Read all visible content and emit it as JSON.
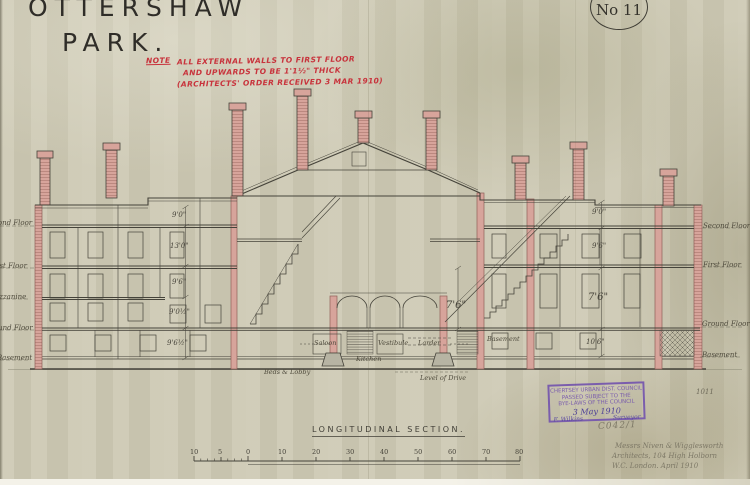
{
  "title": {
    "line1": "OTTERSHAW",
    "line2": "PARK."
  },
  "drawing_number": "No 11",
  "note": {
    "label": "NOTE",
    "line1": "ALL EXTERNAL WALLS TO FIRST FLOOR",
    "line2": "AND UPWARDS TO BE 1'1½\" THICK",
    "line3": "(ARCHITECTS' ORDER RECEIVED 3 MAR 1910)"
  },
  "section_title": "LONGITUDINAL SECTION.",
  "floor_labels": {
    "right": [
      "Second Floor",
      "First Floor",
      "Ground Floor",
      "Basement"
    ],
    "left": [
      "Second Floor",
      "First Floor",
      "Mezzanine",
      "Ground Floor",
      "Basement"
    ]
  },
  "dimensions": {
    "left": [
      "9'0\"",
      "13'0\"",
      "9'6\"",
      "9'0½\"",
      "9'6½\""
    ],
    "right": [
      "9'0\"",
      "9'6\"",
      "7'6\"",
      "10'6\""
    ],
    "center": "7'6\""
  },
  "rooms": {
    "saloon": "Saloon",
    "kitchen": "Kitchen",
    "vestibule": "Vestibule",
    "larder": "Larder",
    "basement": "Basement",
    "beds_lobby": "Beds & Lobby",
    "level_of_drive": "Level of Drive"
  },
  "scale_bar": {
    "labels": [
      "10",
      "5",
      "0",
      "10",
      "20",
      "30",
      "40",
      "50",
      "60",
      "70",
      "80"
    ]
  },
  "stamp": {
    "line1": "CHERTSEY URBAN DIST. COUNCIL",
    "line2": "PASSED SUBJECT TO THE",
    "line3": "BYE-LAWS OF THE COUNCIL",
    "date": "3 May 1910",
    "signature": "F. Wilkins",
    "officer_title": "Surveyor"
  },
  "annotations": {
    "ref_number": "C042/1",
    "archive_number": "1011",
    "architect_line1": "Messrs Niven & Wigglesworth",
    "architect_line2": "Architects, 104 High Holborn",
    "architect_line3": "W.C. London.  April 1910"
  },
  "colors": {
    "paper": "#cdc9b4",
    "ink": "#45433a",
    "wall_pink": "#d7a49b",
    "note_red": "#c8333c",
    "stamp_purple": "#7a5dad",
    "pencil": "#7d7866"
  }
}
